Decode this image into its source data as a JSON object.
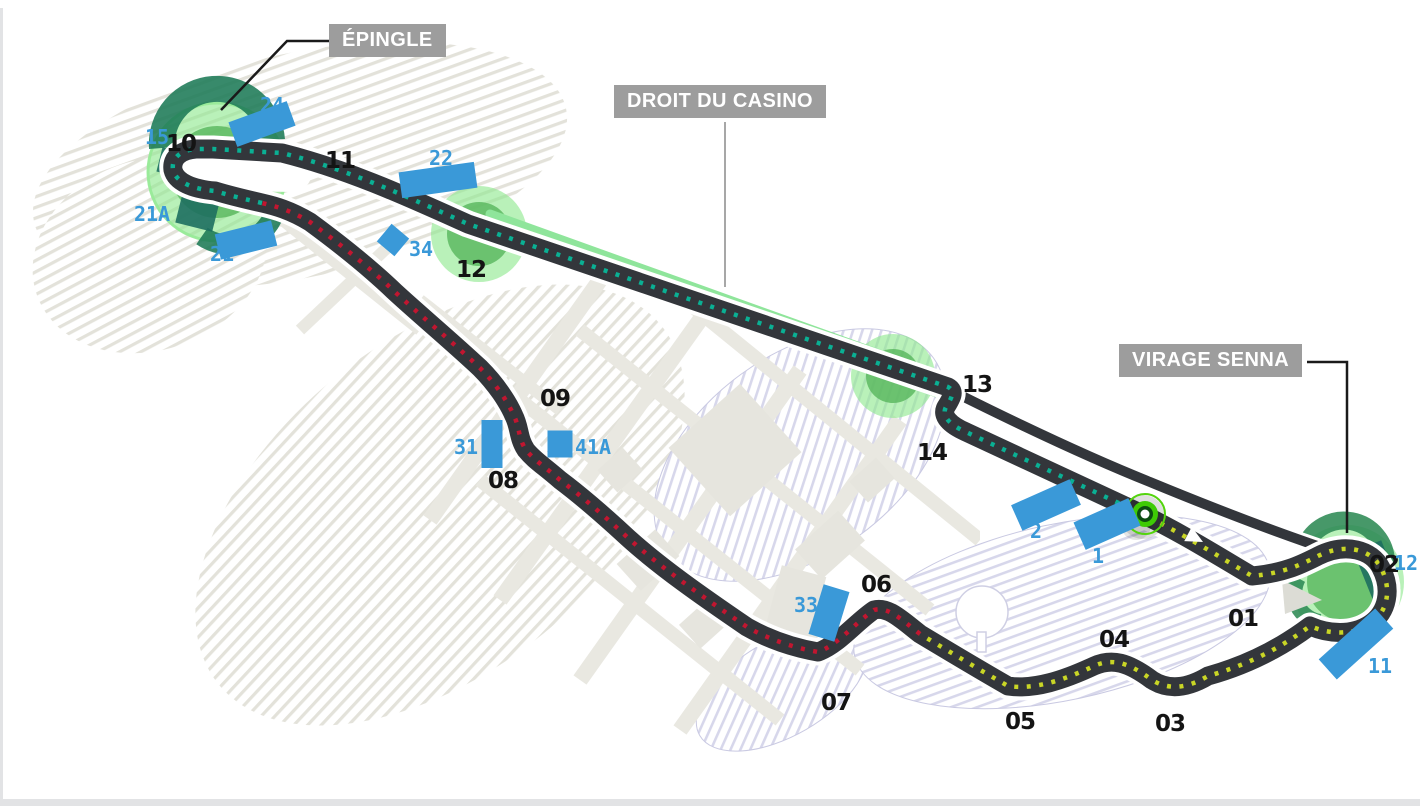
{
  "callouts": {
    "epingle": "ÉPINGLE",
    "droit_du_casino": "DROIT DU CASINO",
    "virage_senna": "VIRAGE SENNA"
  },
  "corners": {
    "c01": "01",
    "c02": "02",
    "c03": "03",
    "c04": "04",
    "c05": "05",
    "c06": "06",
    "c07": "07",
    "c08": "08",
    "c09": "09",
    "c10": "10",
    "c11": "11",
    "c12": "12",
    "c13": "13",
    "c14": "14"
  },
  "grandstands": {
    "g24": "24",
    "g15": "15",
    "g21a": "21A",
    "g21": "21",
    "g22": "22",
    "g34": "34",
    "g31": "31",
    "g41a": "41A",
    "g2": "2",
    "g1": "1",
    "g33": "33",
    "g12": "12",
    "g11": "11"
  },
  "colors": {
    "track": "#33363b",
    "track_casing": "#ffffff",
    "sector_teal": "#0ab094",
    "sector_red": "#c11630",
    "sector_yellow": "#c9d626",
    "grandstand_blue": "#3a99d8",
    "stand_dark_green": "#1d7a56",
    "glow_outer": "#8ee88e",
    "glow_inner": "#58b75c",
    "drs_band": "#8fe59b",
    "start_finish_ring": "#3ecb05",
    "callout_bg": "#9d9d9d",
    "callout_text": "#ffffff",
    "corner_number": "#141414",
    "water_hatch": "#e3e2da",
    "park_hatch": "#d7d7eb",
    "building": "#e6e5de",
    "street": "#e9e8e1"
  }
}
